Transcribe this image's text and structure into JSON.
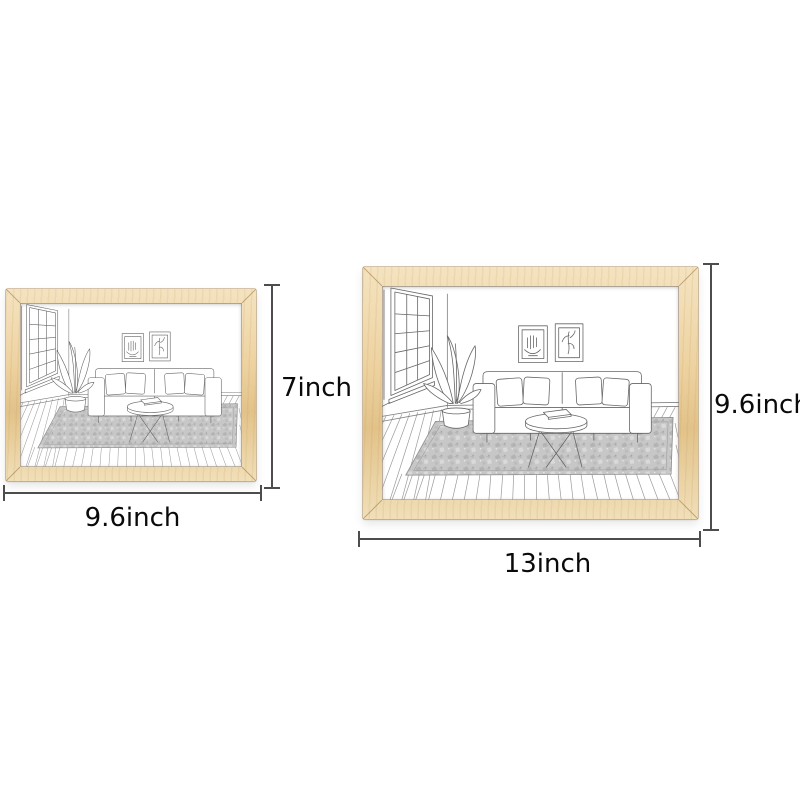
{
  "title": "wooden frame size comparison",
  "canvas": {
    "background": "#ffffff"
  },
  "colors": {
    "canvas_background": "#ffffff",
    "wood": "#eed3a2",
    "wood_highlight": "#f4e3c0",
    "wood_shadow": "#e2c289",
    "dimension_line": "#4d4d4d",
    "label_text": "#0a0a0a",
    "sketch_line": "#666666",
    "floor_line": "#9a9a9a"
  },
  "frames": {
    "small": {
      "name": "small frame",
      "width_label": "9.6inch",
      "height_label": "7inch"
    },
    "large": {
      "name": "large frame",
      "width_label": "13inch",
      "height_label": "9.6inch"
    }
  },
  "artwork": {
    "description": "line sketch of a living room: grid window, potted plant, sofa with four pillows, two framed wall pictures, round coffee table with a book, textured rug, wood plank floor"
  }
}
